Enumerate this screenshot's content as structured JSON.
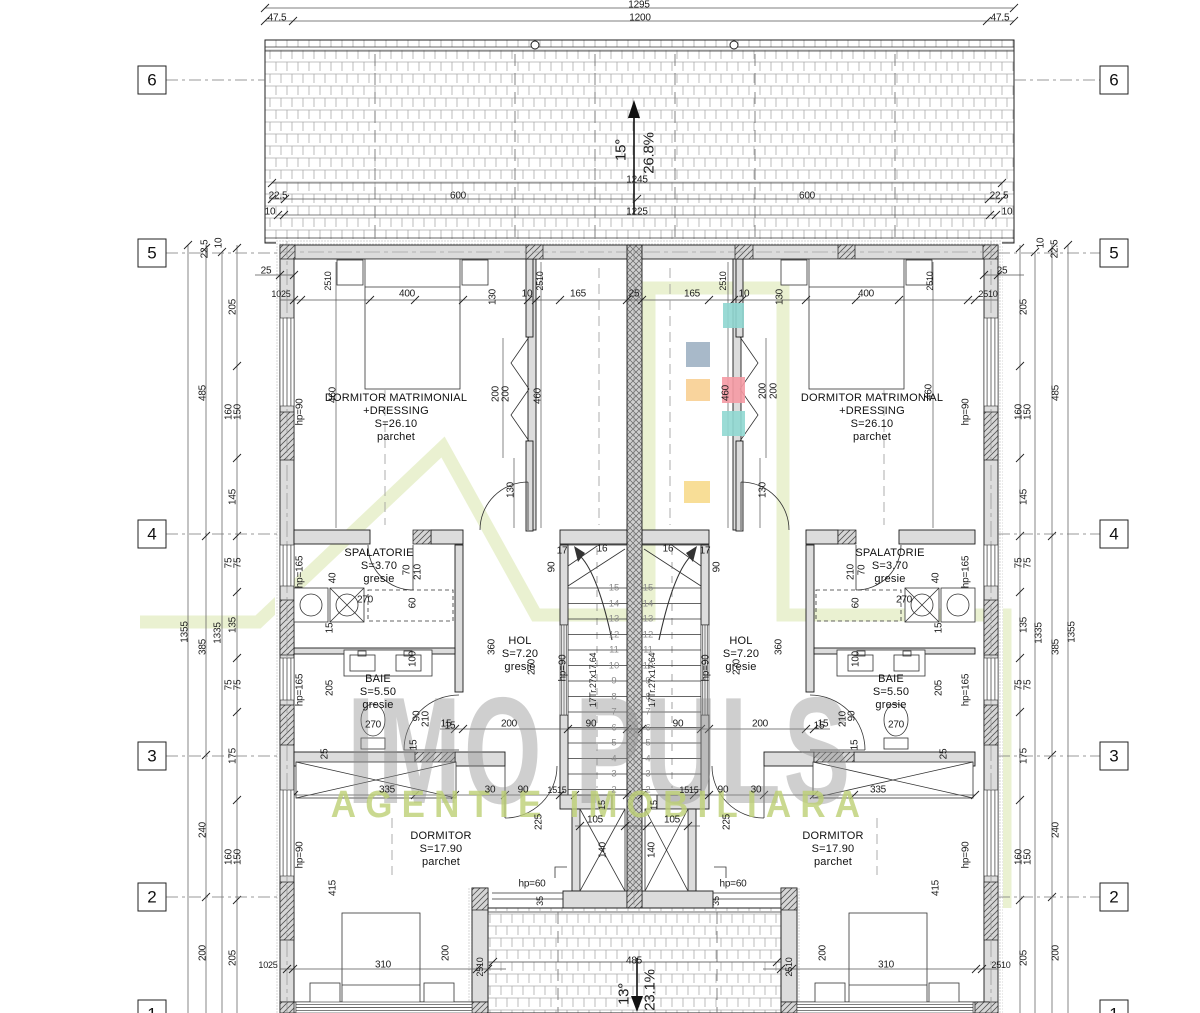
{
  "watermark": {
    "title": "IMO PULS",
    "subtitle": "AGENTIE IMOBILIARA",
    "logo_color": "#d9e6ab",
    "title_color": "#8f8f8f",
    "subtitle_color": "#bdd075"
  },
  "grid": {
    "labels": [
      "6",
      "5",
      "4",
      "3",
      "2",
      "1"
    ],
    "ys": [
      80,
      253,
      534,
      756,
      897,
      1014
    ],
    "left_x": 152,
    "right_x": 1114
  },
  "roof": {
    "upper": {
      "angle": "15°",
      "slope": "26.8%"
    },
    "lower": {
      "angle": "13°",
      "slope": "23.1%"
    }
  },
  "stairs": {
    "note": "17Tr.27x17.64",
    "numbers": [
      "2",
      "3",
      "4",
      "5",
      "6",
      "7",
      "8",
      "9",
      "10",
      "11",
      "12",
      "13",
      "14",
      "15"
    ],
    "left_col_x": 614,
    "right_col_x": 648,
    "bottom_y": 790,
    "step": 15.53
  },
  "rooms": [
    {
      "x": 396,
      "y": 392,
      "lines": [
        "DORMITOR MATRIMONIAL",
        "+DRESSING",
        "S=26.10",
        "parchet"
      ]
    },
    {
      "x": 872,
      "y": 392,
      "lines": [
        "DORMITOR MATRIMONIAL",
        "+DRESSING",
        "S=26.10",
        "parchet"
      ]
    },
    {
      "x": 379,
      "y": 547,
      "lines": [
        "SPALATORIE",
        "S=3.70",
        "gresie"
      ]
    },
    {
      "x": 890,
      "y": 547,
      "lines": [
        "SPALATORIE",
        "S=3.70",
        "gresie"
      ]
    },
    {
      "x": 378,
      "y": 673,
      "lines": [
        "BAIE",
        "S=5.50",
        "gresie"
      ]
    },
    {
      "x": 891,
      "y": 673,
      "lines": [
        "BAIE",
        "S=5.50",
        "gresie"
      ]
    },
    {
      "x": 520,
      "y": 635,
      "lines": [
        "HOL",
        "S=7.20",
        "gresie"
      ]
    },
    {
      "x": 741,
      "y": 635,
      "lines": [
        "HOL",
        "S=7.20",
        "gresie"
      ]
    },
    {
      "x": 441,
      "y": 830,
      "lines": [
        "DORMITOR",
        "S=17.90",
        "parchet"
      ]
    },
    {
      "x": 833,
      "y": 830,
      "lines": [
        "DORMITOR",
        "S=17.90",
        "parchet"
      ]
    }
  ],
  "swatches": [
    {
      "x": 723,
      "y": 303,
      "w": 21,
      "h": 25,
      "c": "#8fd6d0"
    },
    {
      "x": 686,
      "y": 342,
      "w": 24,
      "h": 25,
      "c": "#9fb1c3"
    },
    {
      "x": 686,
      "y": 379,
      "w": 24,
      "h": 22,
      "c": "#f8cf92"
    },
    {
      "x": 722,
      "y": 377,
      "w": 23,
      "h": 26,
      "c": "#f59aa4"
    },
    {
      "x": 722,
      "y": 411,
      "w": 23,
      "h": 25,
      "c": "#90d8d2"
    },
    {
      "x": 684,
      "y": 481,
      "w": 26,
      "h": 22,
      "c": "#f7da8c"
    }
  ],
  "dims": [
    {
      "t": "1295",
      "x": 639,
      "y": 5
    },
    {
      "t": "47.5",
      "x": 277,
      "y": 18
    },
    {
      "t": "1200",
      "x": 640,
      "y": 18
    },
    {
      "t": "47.5",
      "x": 1000,
      "y": 18
    },
    {
      "t": "15°",
      "x": 621,
      "y": 150,
      "r": 1,
      "s": 15
    },
    {
      "t": "26.8%",
      "x": 649,
      "y": 153,
      "r": 1,
      "s": 15
    },
    {
      "t": "1245",
      "x": 637,
      "y": 180
    },
    {
      "t": "22.5",
      "x": 278,
      "y": 196
    },
    {
      "t": "600",
      "x": 458,
      "y": 196
    },
    {
      "t": "600",
      "x": 807,
      "y": 196
    },
    {
      "t": "22.5",
      "x": 999,
      "y": 196
    },
    {
      "t": "10",
      "x": 270,
      "y": 212
    },
    {
      "t": "1225",
      "x": 637,
      "y": 212
    },
    {
      "t": "10",
      "x": 1007,
      "y": 212
    },
    {
      "t": "22.5",
      "x": 205,
      "y": 249,
      "r": 1
    },
    {
      "t": "10",
      "x": 219,
      "y": 243,
      "r": 1
    },
    {
      "t": "25",
      "x": 266,
      "y": 271
    },
    {
      "t": "1025",
      "x": 281,
      "y": 294,
      "s": 9
    },
    {
      "t": "205",
      "x": 233,
      "y": 307,
      "r": 1
    },
    {
      "t": "485",
      "x": 203,
      "y": 393,
      "r": 1
    },
    {
      "t": "160",
      "x": 229,
      "y": 412,
      "r": 1
    },
    {
      "t": "150",
      "x": 238,
      "y": 412,
      "r": 1
    },
    {
      "t": "145",
      "x": 233,
      "y": 497,
      "r": 1
    },
    {
      "t": "75",
      "x": 229,
      "y": 563,
      "r": 1
    },
    {
      "t": "75",
      "x": 238,
      "y": 563,
      "r": 1
    },
    {
      "t": "1355",
      "x": 185,
      "y": 632,
      "r": 1
    },
    {
      "t": "1335",
      "x": 218,
      "y": 633,
      "r": 1
    },
    {
      "t": "135",
      "x": 233,
      "y": 625,
      "r": 1
    },
    {
      "t": "385",
      "x": 203,
      "y": 647,
      "r": 1
    },
    {
      "t": "75",
      "x": 229,
      "y": 685,
      "r": 1
    },
    {
      "t": "75",
      "x": 238,
      "y": 685,
      "r": 1
    },
    {
      "t": "175",
      "x": 233,
      "y": 756,
      "r": 1
    },
    {
      "t": "240",
      "x": 203,
      "y": 830,
      "r": 1
    },
    {
      "t": "160",
      "x": 229,
      "y": 857,
      "r": 1
    },
    {
      "t": "150",
      "x": 238,
      "y": 857,
      "r": 1
    },
    {
      "t": "200",
      "x": 203,
      "y": 953,
      "r": 1
    },
    {
      "t": "205",
      "x": 233,
      "y": 958,
      "r": 1
    },
    {
      "t": "10",
      "x": 1041,
      "y": 243,
      "r": 1
    },
    {
      "t": "22.5",
      "x": 1055,
      "y": 249,
      "r": 1
    },
    {
      "t": "25",
      "x": 1002,
      "y": 271
    },
    {
      "t": "2510",
      "x": 988,
      "y": 294,
      "s": 9
    },
    {
      "t": "205",
      "x": 1024,
      "y": 307,
      "r": 1
    },
    {
      "t": "485",
      "x": 1056,
      "y": 393,
      "r": 1
    },
    {
      "t": "160",
      "x": 1019,
      "y": 412,
      "r": 1
    },
    {
      "t": "150",
      "x": 1028,
      "y": 412,
      "r": 1
    },
    {
      "t": "145",
      "x": 1024,
      "y": 497,
      "r": 1
    },
    {
      "t": "75",
      "x": 1019,
      "y": 563,
      "r": 1
    },
    {
      "t": "75",
      "x": 1028,
      "y": 563,
      "r": 1
    },
    {
      "t": "1355",
      "x": 1072,
      "y": 632,
      "r": 1
    },
    {
      "t": "1335",
      "x": 1039,
      "y": 633,
      "r": 1
    },
    {
      "t": "135",
      "x": 1024,
      "y": 625,
      "r": 1
    },
    {
      "t": "385",
      "x": 1056,
      "y": 647,
      "r": 1
    },
    {
      "t": "75",
      "x": 1019,
      "y": 685,
      "r": 1
    },
    {
      "t": "75",
      "x": 1028,
      "y": 685,
      "r": 1
    },
    {
      "t": "175",
      "x": 1024,
      "y": 756,
      "r": 1
    },
    {
      "t": "240",
      "x": 1056,
      "y": 830,
      "r": 1
    },
    {
      "t": "160",
      "x": 1019,
      "y": 857,
      "r": 1
    },
    {
      "t": "150",
      "x": 1028,
      "y": 857,
      "r": 1
    },
    {
      "t": "200",
      "x": 1056,
      "y": 953,
      "r": 1
    },
    {
      "t": "205",
      "x": 1024,
      "y": 958,
      "r": 1
    },
    {
      "t": "400",
      "x": 407,
      "y": 294
    },
    {
      "t": "130",
      "x": 493,
      "y": 297,
      "r": 1
    },
    {
      "t": "10",
      "x": 527,
      "y": 294
    },
    {
      "t": "165",
      "x": 578,
      "y": 294
    },
    {
      "t": "25",
      "x": 634,
      "y": 294
    },
    {
      "t": "165",
      "x": 692,
      "y": 294
    },
    {
      "t": "10",
      "x": 744,
      "y": 294
    },
    {
      "t": "130",
      "x": 780,
      "y": 297,
      "r": 1
    },
    {
      "t": "400",
      "x": 866,
      "y": 294
    },
    {
      "t": "2510",
      "x": 328,
      "y": 281,
      "r": 1,
      "s": 9
    },
    {
      "t": "2510",
      "x": 540,
      "y": 281,
      "r": 1,
      "s": 9
    },
    {
      "t": "2510",
      "x": 723,
      "y": 281,
      "r": 1,
      "s": 9
    },
    {
      "t": "2510",
      "x": 930,
      "y": 281,
      "r": 1,
      "s": 9
    },
    {
      "t": "hp=90",
      "x": 300,
      "y": 412,
      "r": 1
    },
    {
      "t": "hp=165",
      "x": 300,
      "y": 572,
      "r": 1
    },
    {
      "t": "hp=165",
      "x": 300,
      "y": 690,
      "r": 1
    },
    {
      "t": "hp=90",
      "x": 300,
      "y": 855,
      "r": 1
    },
    {
      "t": "hp=90",
      "x": 966,
      "y": 412,
      "r": 1
    },
    {
      "t": "hp=165",
      "x": 966,
      "y": 572,
      "r": 1
    },
    {
      "t": "hp=165",
      "x": 966,
      "y": 690,
      "r": 1
    },
    {
      "t": "hp=90",
      "x": 966,
      "y": 855,
      "r": 1
    },
    {
      "t": "hp=90",
      "x": 563,
      "y": 668,
      "r": 1
    },
    {
      "t": "hp=90",
      "x": 706,
      "y": 668,
      "r": 1
    },
    {
      "t": "hp=60",
      "x": 532,
      "y": 884
    },
    {
      "t": "hp=60",
      "x": 733,
      "y": 884
    },
    {
      "t": "460",
      "x": 333,
      "y": 395,
      "r": 1
    },
    {
      "t": "200",
      "x": 496,
      "y": 394,
      "r": 1
    },
    {
      "t": "200",
      "x": 506,
      "y": 394,
      "r": 1
    },
    {
      "t": "460",
      "x": 538,
      "y": 396,
      "r": 1
    },
    {
      "t": "460",
      "x": 726,
      "y": 393,
      "r": 1
    },
    {
      "t": "200",
      "x": 763,
      "y": 391,
      "r": 1
    },
    {
      "t": "200",
      "x": 774,
      "y": 391,
      "r": 1
    },
    {
      "t": "460",
      "x": 929,
      "y": 392,
      "r": 1
    },
    {
      "t": "130",
      "x": 511,
      "y": 490,
      "r": 1
    },
    {
      "t": "130",
      "x": 763,
      "y": 490,
      "r": 1
    },
    {
      "t": "40",
      "x": 333,
      "y": 578,
      "r": 1
    },
    {
      "t": "270",
      "x": 365,
      "y": 600
    },
    {
      "t": "70",
      "x": 407,
      "y": 570,
      "r": 1
    },
    {
      "t": "210",
      "x": 418,
      "y": 572,
      "r": 1
    },
    {
      "t": "60",
      "x": 413,
      "y": 603,
      "r": 1
    },
    {
      "t": "15",
      "x": 330,
      "y": 628,
      "r": 1
    },
    {
      "t": "40",
      "x": 936,
      "y": 578,
      "r": 1
    },
    {
      "t": "270",
      "x": 904,
      "y": 600
    },
    {
      "t": "70",
      "x": 862,
      "y": 570,
      "r": 1
    },
    {
      "t": "210",
      "x": 851,
      "y": 572,
      "r": 1
    },
    {
      "t": "60",
      "x": 856,
      "y": 603,
      "r": 1
    },
    {
      "t": "15",
      "x": 939,
      "y": 628,
      "r": 1
    },
    {
      "t": "100",
      "x": 413,
      "y": 659,
      "r": 1
    },
    {
      "t": "205",
      "x": 330,
      "y": 688,
      "r": 1
    },
    {
      "t": "270",
      "x": 373,
      "y": 725
    },
    {
      "t": "90",
      "x": 417,
      "y": 716,
      "r": 1
    },
    {
      "t": "210",
      "x": 426,
      "y": 719,
      "r": 1
    },
    {
      "t": "15",
      "x": 450,
      "y": 726
    },
    {
      "t": "15",
      "x": 414,
      "y": 745,
      "r": 1
    },
    {
      "t": "25",
      "x": 325,
      "y": 754,
      "r": 1
    },
    {
      "t": "100",
      "x": 856,
      "y": 659,
      "r": 1
    },
    {
      "t": "205",
      "x": 939,
      "y": 688,
      "r": 1
    },
    {
      "t": "270",
      "x": 896,
      "y": 725
    },
    {
      "t": "90",
      "x": 852,
      "y": 716,
      "r": 1
    },
    {
      "t": "210",
      "x": 843,
      "y": 719,
      "r": 1
    },
    {
      "t": "15",
      "x": 819,
      "y": 726
    },
    {
      "t": "15",
      "x": 855,
      "y": 745,
      "r": 1
    },
    {
      "t": "25",
      "x": 944,
      "y": 754,
      "r": 1
    },
    {
      "t": "360",
      "x": 492,
      "y": 647,
      "r": 1
    },
    {
      "t": "270",
      "x": 532,
      "y": 667,
      "r": 1
    },
    {
      "t": "360",
      "x": 779,
      "y": 647,
      "r": 1
    },
    {
      "t": "270",
      "x": 737,
      "y": 667,
      "r": 1
    },
    {
      "t": "15",
      "x": 446,
      "y": 724
    },
    {
      "t": "200",
      "x": 509,
      "y": 724
    },
    {
      "t": "90",
      "x": 591,
      "y": 724
    },
    {
      "t": "90",
      "x": 678,
      "y": 724
    },
    {
      "t": "200",
      "x": 760,
      "y": 724
    },
    {
      "t": "15",
      "x": 823,
      "y": 724
    },
    {
      "t": "17",
      "x": 562,
      "y": 551
    },
    {
      "t": "16",
      "x": 602,
      "y": 549
    },
    {
      "t": "16",
      "x": 668,
      "y": 549
    },
    {
      "t": "17",
      "x": 705,
      "y": 551
    },
    {
      "t": "90",
      "x": 552,
      "y": 567,
      "r": 1
    },
    {
      "t": "90",
      "x": 717,
      "y": 567,
      "r": 1
    },
    {
      "t": "17Tr.27x17.64",
      "x": 593,
      "y": 680,
      "r": 1,
      "s": 9
    },
    {
      "t": "17Tr.27x17.64",
      "x": 652,
      "y": 680,
      "r": 1,
      "s": 9
    },
    {
      "t": "335",
      "x": 387,
      "y": 790
    },
    {
      "t": "30",
      "x": 490,
      "y": 790
    },
    {
      "t": "90",
      "x": 523,
      "y": 790
    },
    {
      "t": "1515",
      "x": 557,
      "y": 790,
      "s": 9
    },
    {
      "t": "1515",
      "x": 689,
      "y": 790,
      "s": 9
    },
    {
      "t": "90",
      "x": 723,
      "y": 790
    },
    {
      "t": "30",
      "x": 756,
      "y": 790
    },
    {
      "t": "335",
      "x": 878,
      "y": 790
    },
    {
      "t": "15",
      "x": 602,
      "y": 805,
      "r": 1,
      "s": 9
    },
    {
      "t": "15",
      "x": 654,
      "y": 805,
      "r": 1,
      "s": 9
    },
    {
      "t": "105",
      "x": 595,
      "y": 820
    },
    {
      "t": "105",
      "x": 672,
      "y": 820
    },
    {
      "t": "225",
      "x": 539,
      "y": 822,
      "r": 1
    },
    {
      "t": "225",
      "x": 727,
      "y": 822,
      "r": 1
    },
    {
      "t": "140",
      "x": 603,
      "y": 850,
      "r": 1
    },
    {
      "t": "140",
      "x": 652,
      "y": 850,
      "r": 1
    },
    {
      "t": "35",
      "x": 540,
      "y": 901,
      "r": 1,
      "s": 9
    },
    {
      "t": "35",
      "x": 716,
      "y": 901,
      "r": 1,
      "s": 9
    },
    {
      "t": "415",
      "x": 333,
      "y": 888,
      "r": 1
    },
    {
      "t": "415",
      "x": 936,
      "y": 888,
      "r": 1
    },
    {
      "t": "1025",
      "x": 268,
      "y": 965,
      "s": 9
    },
    {
      "t": "310",
      "x": 383,
      "y": 965
    },
    {
      "t": "2510",
      "x": 480,
      "y": 967,
      "r": 1,
      "s": 9
    },
    {
      "t": "485",
      "x": 634,
      "y": 961
    },
    {
      "t": "2510",
      "x": 789,
      "y": 967,
      "r": 1,
      "s": 9
    },
    {
      "t": "310",
      "x": 886,
      "y": 965
    },
    {
      "t": "2510",
      "x": 1001,
      "y": 965,
      "s": 9
    },
    {
      "t": "200",
      "x": 446,
      "y": 953,
      "r": 1
    },
    {
      "t": "200",
      "x": 823,
      "y": 953,
      "r": 1
    },
    {
      "t": "13°",
      "x": 624,
      "y": 994,
      "r": 1,
      "s": 15
    },
    {
      "t": "23.1%",
      "x": 650,
      "y": 990,
      "r": 1,
      "s": 15
    }
  ]
}
